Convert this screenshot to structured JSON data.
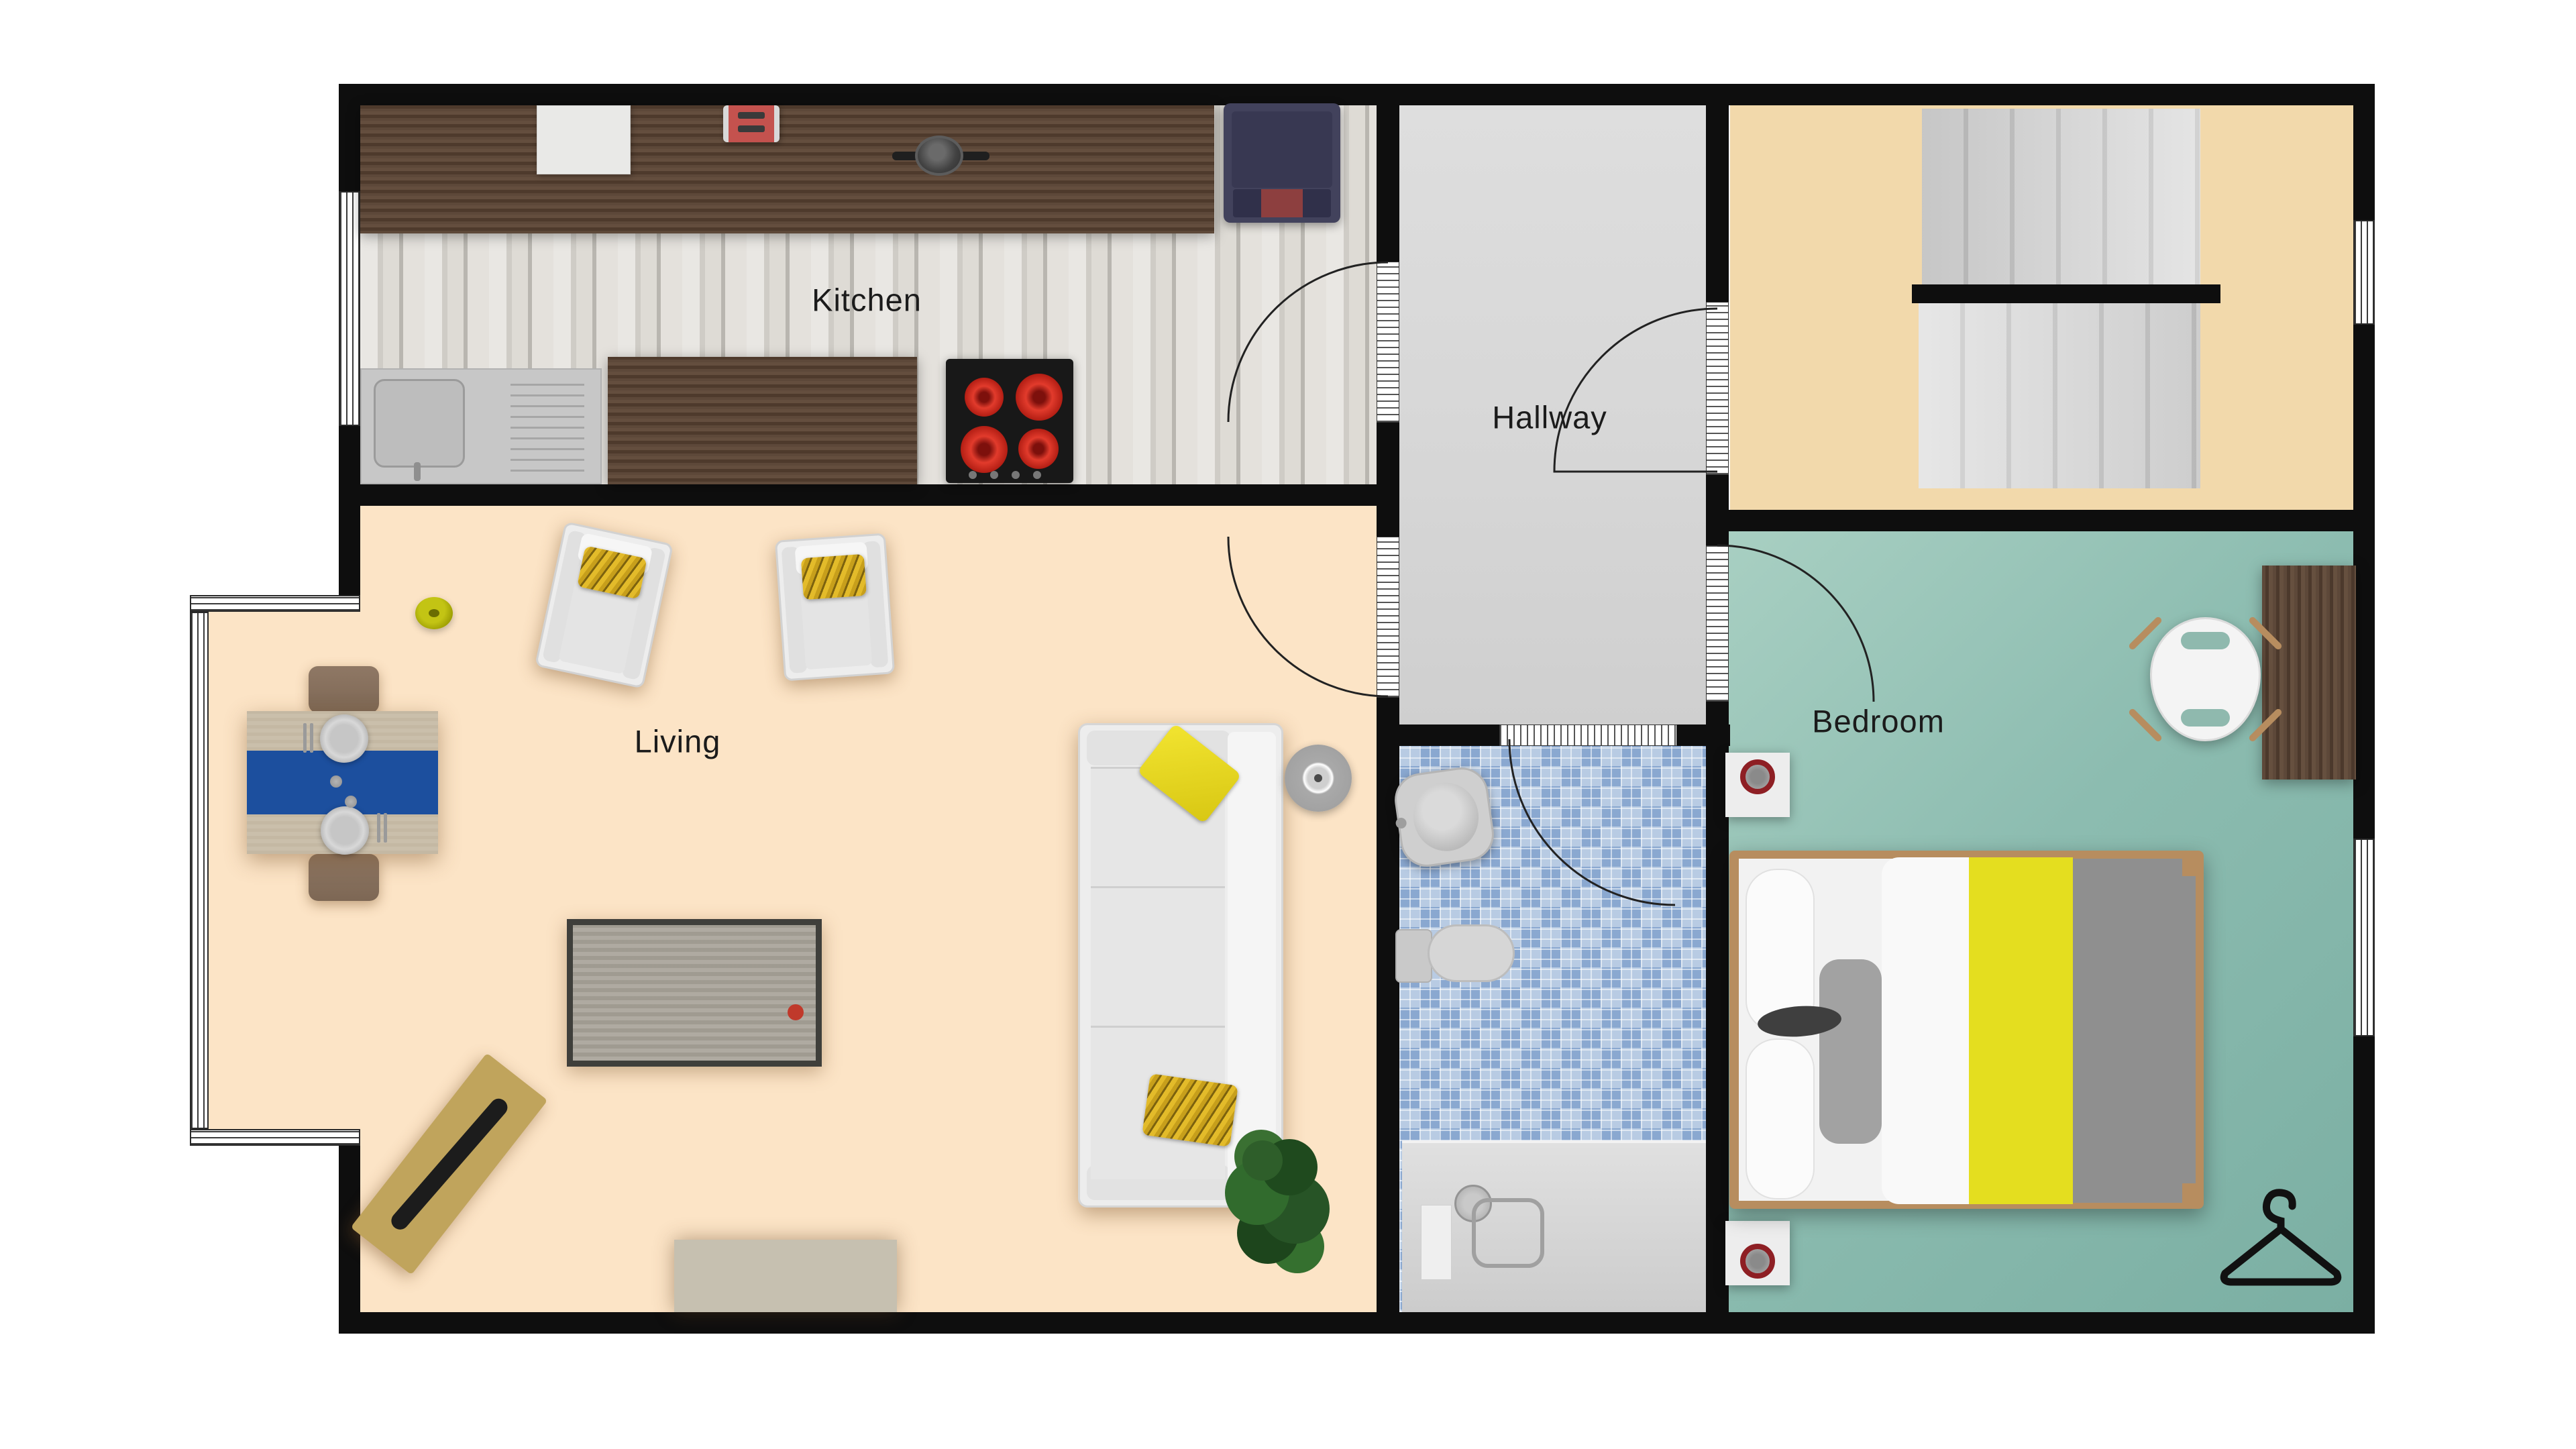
{
  "plan": {
    "type": "residential-floor-plan",
    "wall_color": "#0e0e0e",
    "background": "#ffffff"
  },
  "rooms": {
    "kitchen": {
      "label": "Kitchen",
      "floor": "light-wood-planks",
      "floor_color": "#dcd8d2"
    },
    "hallway": {
      "label": "Hallway",
      "floor_color": "#d9d9d9"
    },
    "living": {
      "label": "Living",
      "floor_color": "#fce4c6"
    },
    "bedroom": {
      "label": "Bedroom",
      "floor_color": "#8cbcb0"
    },
    "bathroom": {
      "floor": "blue-mosaic-tile",
      "floor_color": "#aec4df"
    },
    "stairwell": {
      "floor_color": "#f2d9ab",
      "stairs_flights": 2,
      "treads_per_flight": 6
    }
  },
  "furniture": {
    "kitchen": [
      "counter-top",
      "island-counter",
      "sink-with-drainboard",
      "stove-4-burners",
      "cutting-board",
      "toaster",
      "pan",
      "refrigerator"
    ],
    "living": [
      "bay-window",
      "dining-table",
      "table-runner",
      "2-plates",
      "2-dining-chairs",
      "2-armchairs-yellow-pillows",
      "3-seat-sofa",
      "2-sofa-pillows",
      "media-table-red-button",
      "round-speaker",
      "angled-bench-with-board",
      "rug",
      "plant",
      "yellow-disc"
    ],
    "bathroom": [
      "wash-basin",
      "toilet",
      "shower-tray"
    ],
    "bedroom": [
      "double-bed-yellow-gray-duvet",
      "2-nightstands",
      "2-red-ring-clocks",
      "desk",
      "desk-chair",
      "hanger-symbol"
    ]
  },
  "accent_colors": {
    "duvet_yellow": "#e4de1f",
    "pillow_yellow": "#e3bb2a",
    "runner_blue": "#1c4f9e",
    "burner_red": "#e23b2c",
    "ring_red": "#8e1f24",
    "bench_tan": "#c0a45c",
    "bed_frame_tan": "#b78d5f",
    "fridge_navy": "#42425c"
  },
  "doors": {
    "count": 5,
    "style": "quarter-arc-swing"
  },
  "windows": {
    "count": 4,
    "style": "triple-line-frame"
  }
}
